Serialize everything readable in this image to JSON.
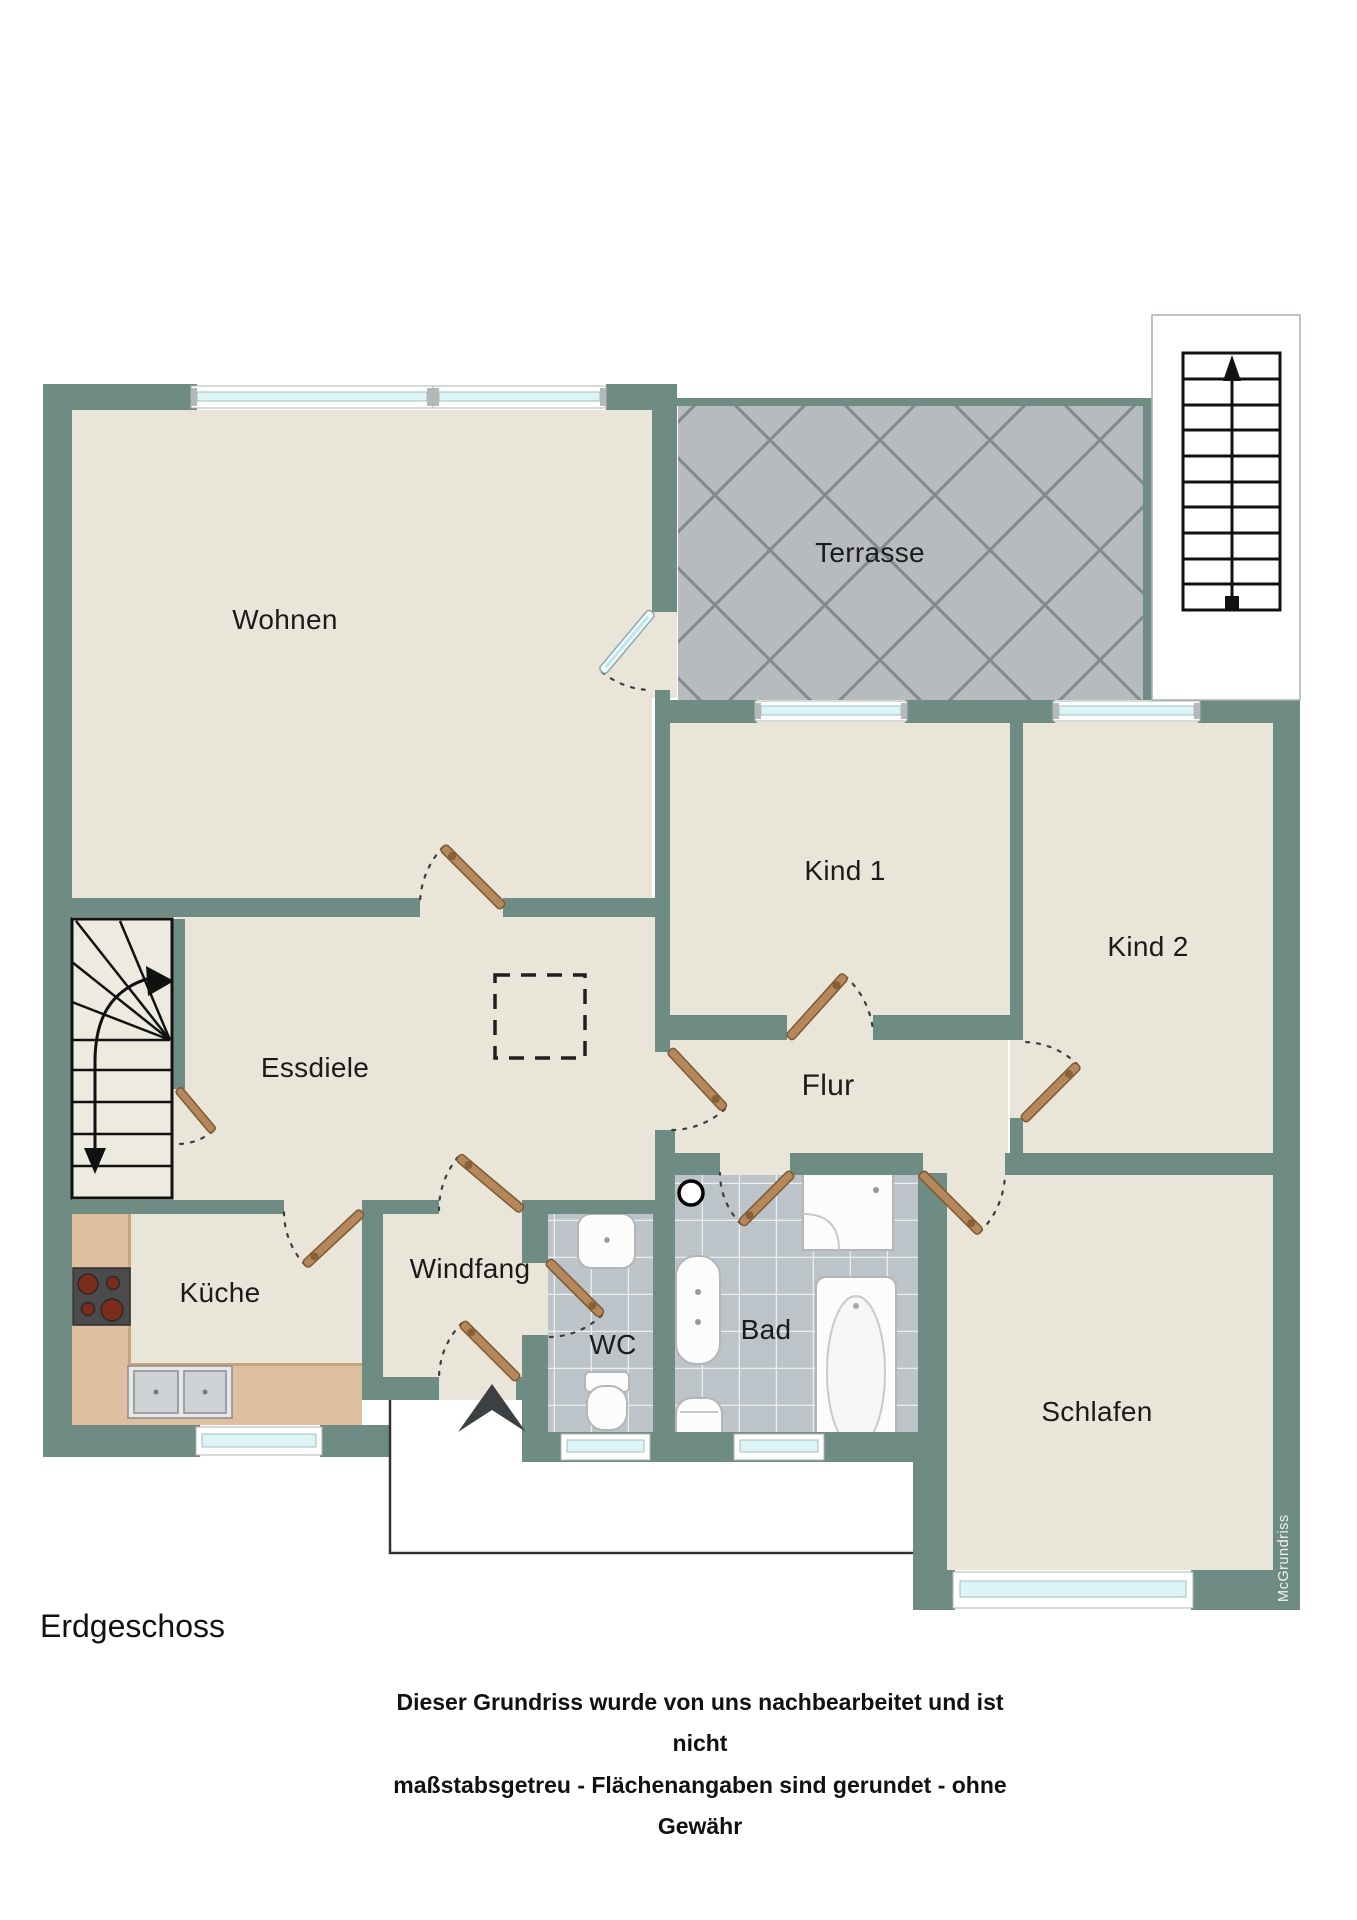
{
  "plan": {
    "floor_label": "Erdgeschoss",
    "watermark": "McGrundriss",
    "disclaimer_line1": "Dieser Grundriss wurde von uns nachbearbeitet und ist nicht",
    "disclaimer_line2": "maßstabsgetreu - Flächenangaben sind gerundet - ohne Gewähr",
    "rooms": {
      "wohnen": "Wohnen",
      "terrasse": "Terrasse",
      "kind1": "Kind 1",
      "kind2": "Kind 2",
      "essdiele": "Essdiele",
      "flur": "Flur",
      "kueche": "Küche",
      "windfang": "Windfang",
      "wc": "WC",
      "bad": "Bad",
      "schlafen": "Schlafen"
    },
    "colors": {
      "wall": "#6e8c83",
      "floor": "#e9e5d8",
      "terrace_tile": "#b7bbbe",
      "bath_tile": "#bdc4c9",
      "kitchen_counter": "#debf9f",
      "door_leaf": "#b6875a",
      "window_glass": "#ddf4f6"
    }
  }
}
